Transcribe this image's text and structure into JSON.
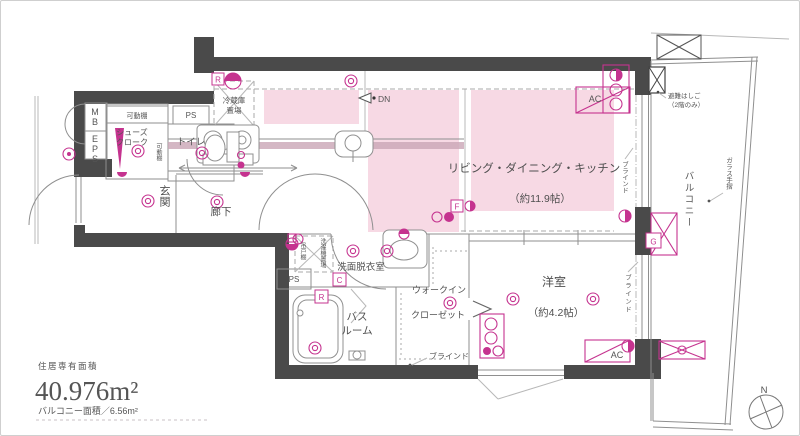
{
  "colors": {
    "wall": "#4a4a4a",
    "pink_floor": "#f7d9e4",
    "magenta": "#c5338f"
  },
  "rooms": {
    "ldk": {
      "name": "リビング・ダイニング・キッチン",
      "size": "（約11.9帖）"
    },
    "bedroom": {
      "name": "洋室",
      "size": "（約4.2帖）"
    },
    "entrance": "玄関",
    "hallway": "廊下",
    "toilet": "トイレ",
    "washroom": "洗面脱衣室",
    "bath_line1": "バス",
    "bath_line2": "ルーム",
    "wic_line1": "ウォークイン",
    "wic_line2": "クローゼット",
    "balcony": "バルコニー"
  },
  "features": {
    "mb": "MB",
    "eps": "EPS",
    "ps": "PS",
    "movable_shelf": "可動棚",
    "shoe_line1": "シューズ",
    "shoe_line2": "クローク",
    "fridge_line1": "冷蔵庫",
    "fridge_line2": "置場",
    "washer": "洗濯機置場",
    "hanging_cupboard": "吊戸棚",
    "dn": "DN",
    "blind": "ブラインド",
    "glass_rail": "ガラス手摺",
    "escape_line1": "避難はしご",
    "escape_line2": "（2階のみ）",
    "ac": "AC",
    "r": "R",
    "c": "C",
    "g": "G",
    "f": "F"
  },
  "area": {
    "caption": "住居専有面積",
    "value": "40.976m²",
    "balcony": "バルコニー面積／6.56m²"
  },
  "compass": {
    "north": "N"
  }
}
